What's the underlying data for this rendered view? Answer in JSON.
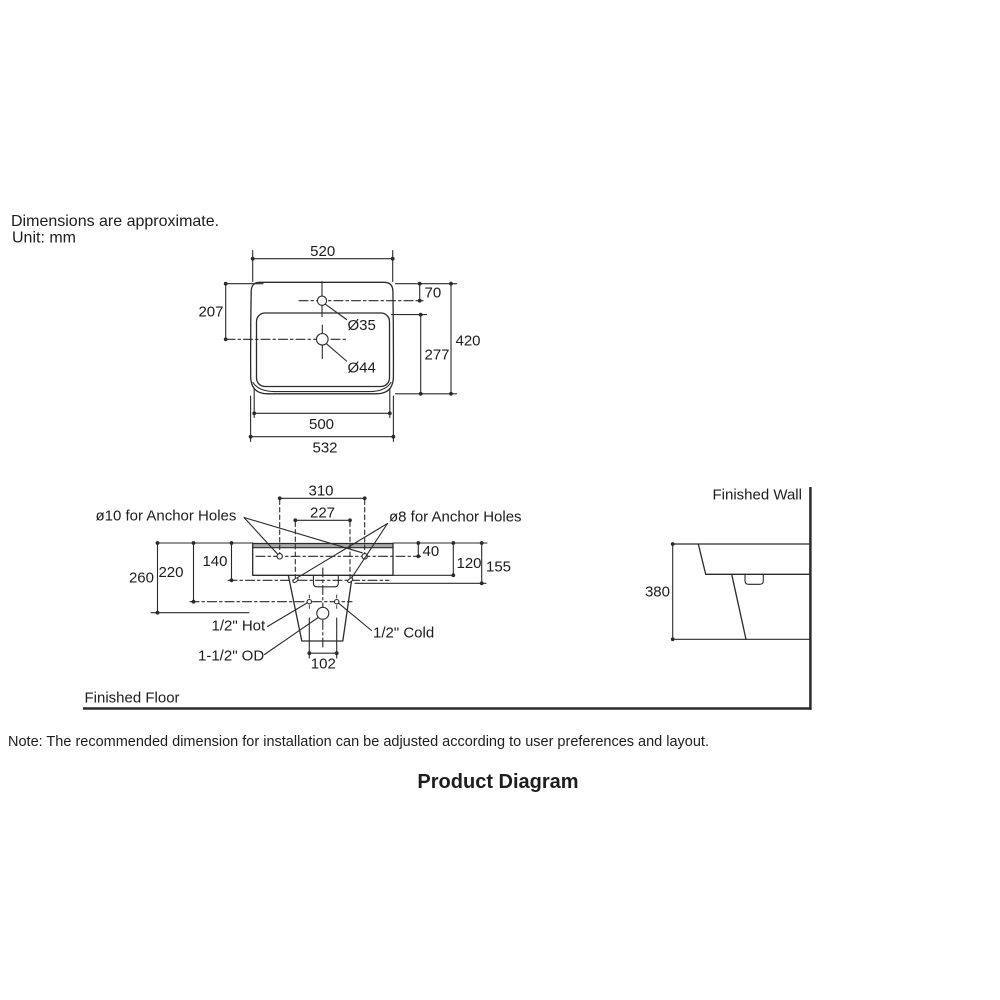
{
  "header": {
    "line1": "Dimensions are approximate.",
    "line2": "Unit: mm"
  },
  "top_view": {
    "width_top": "520",
    "offset_faucet": "70",
    "offset_left": "207",
    "faucet_hole_dia": "Ø35",
    "drain_hole_dia": "Ø44",
    "depth_inner": "277",
    "depth_total": "420",
    "width_inner": "500",
    "width_total": "532"
  },
  "front_view": {
    "anchor_span_outer": "310",
    "anchor_span_inner": "227",
    "anchor_label_left": "ø10 for Anchor Holes",
    "anchor_label_right": "ø8 for Anchor Holes",
    "drop_anchor10": "40",
    "drop_body": "120",
    "drop_anchor8_right": "155",
    "drop_anchor8_left": "140",
    "drop_supply": "220",
    "drop_drain": "260",
    "hot_label": "1/2\" Hot",
    "cold_label": "1/2\" Cold",
    "od_label": "1-1/2\" OD",
    "trap_width": "102",
    "floor_label": "Finished Floor"
  },
  "side_view": {
    "wall_label": "Finished Wall",
    "height_overall": "380"
  },
  "note": "Note: The recommended dimension for installation can be adjusted according to user preferences and layout.",
  "title": "Product Diagram",
  "colors": {
    "line": "#2b2b2b",
    "text": "#1d1d1d",
    "rim_fill": "#a8a8a8",
    "background": "#ffffff"
  }
}
